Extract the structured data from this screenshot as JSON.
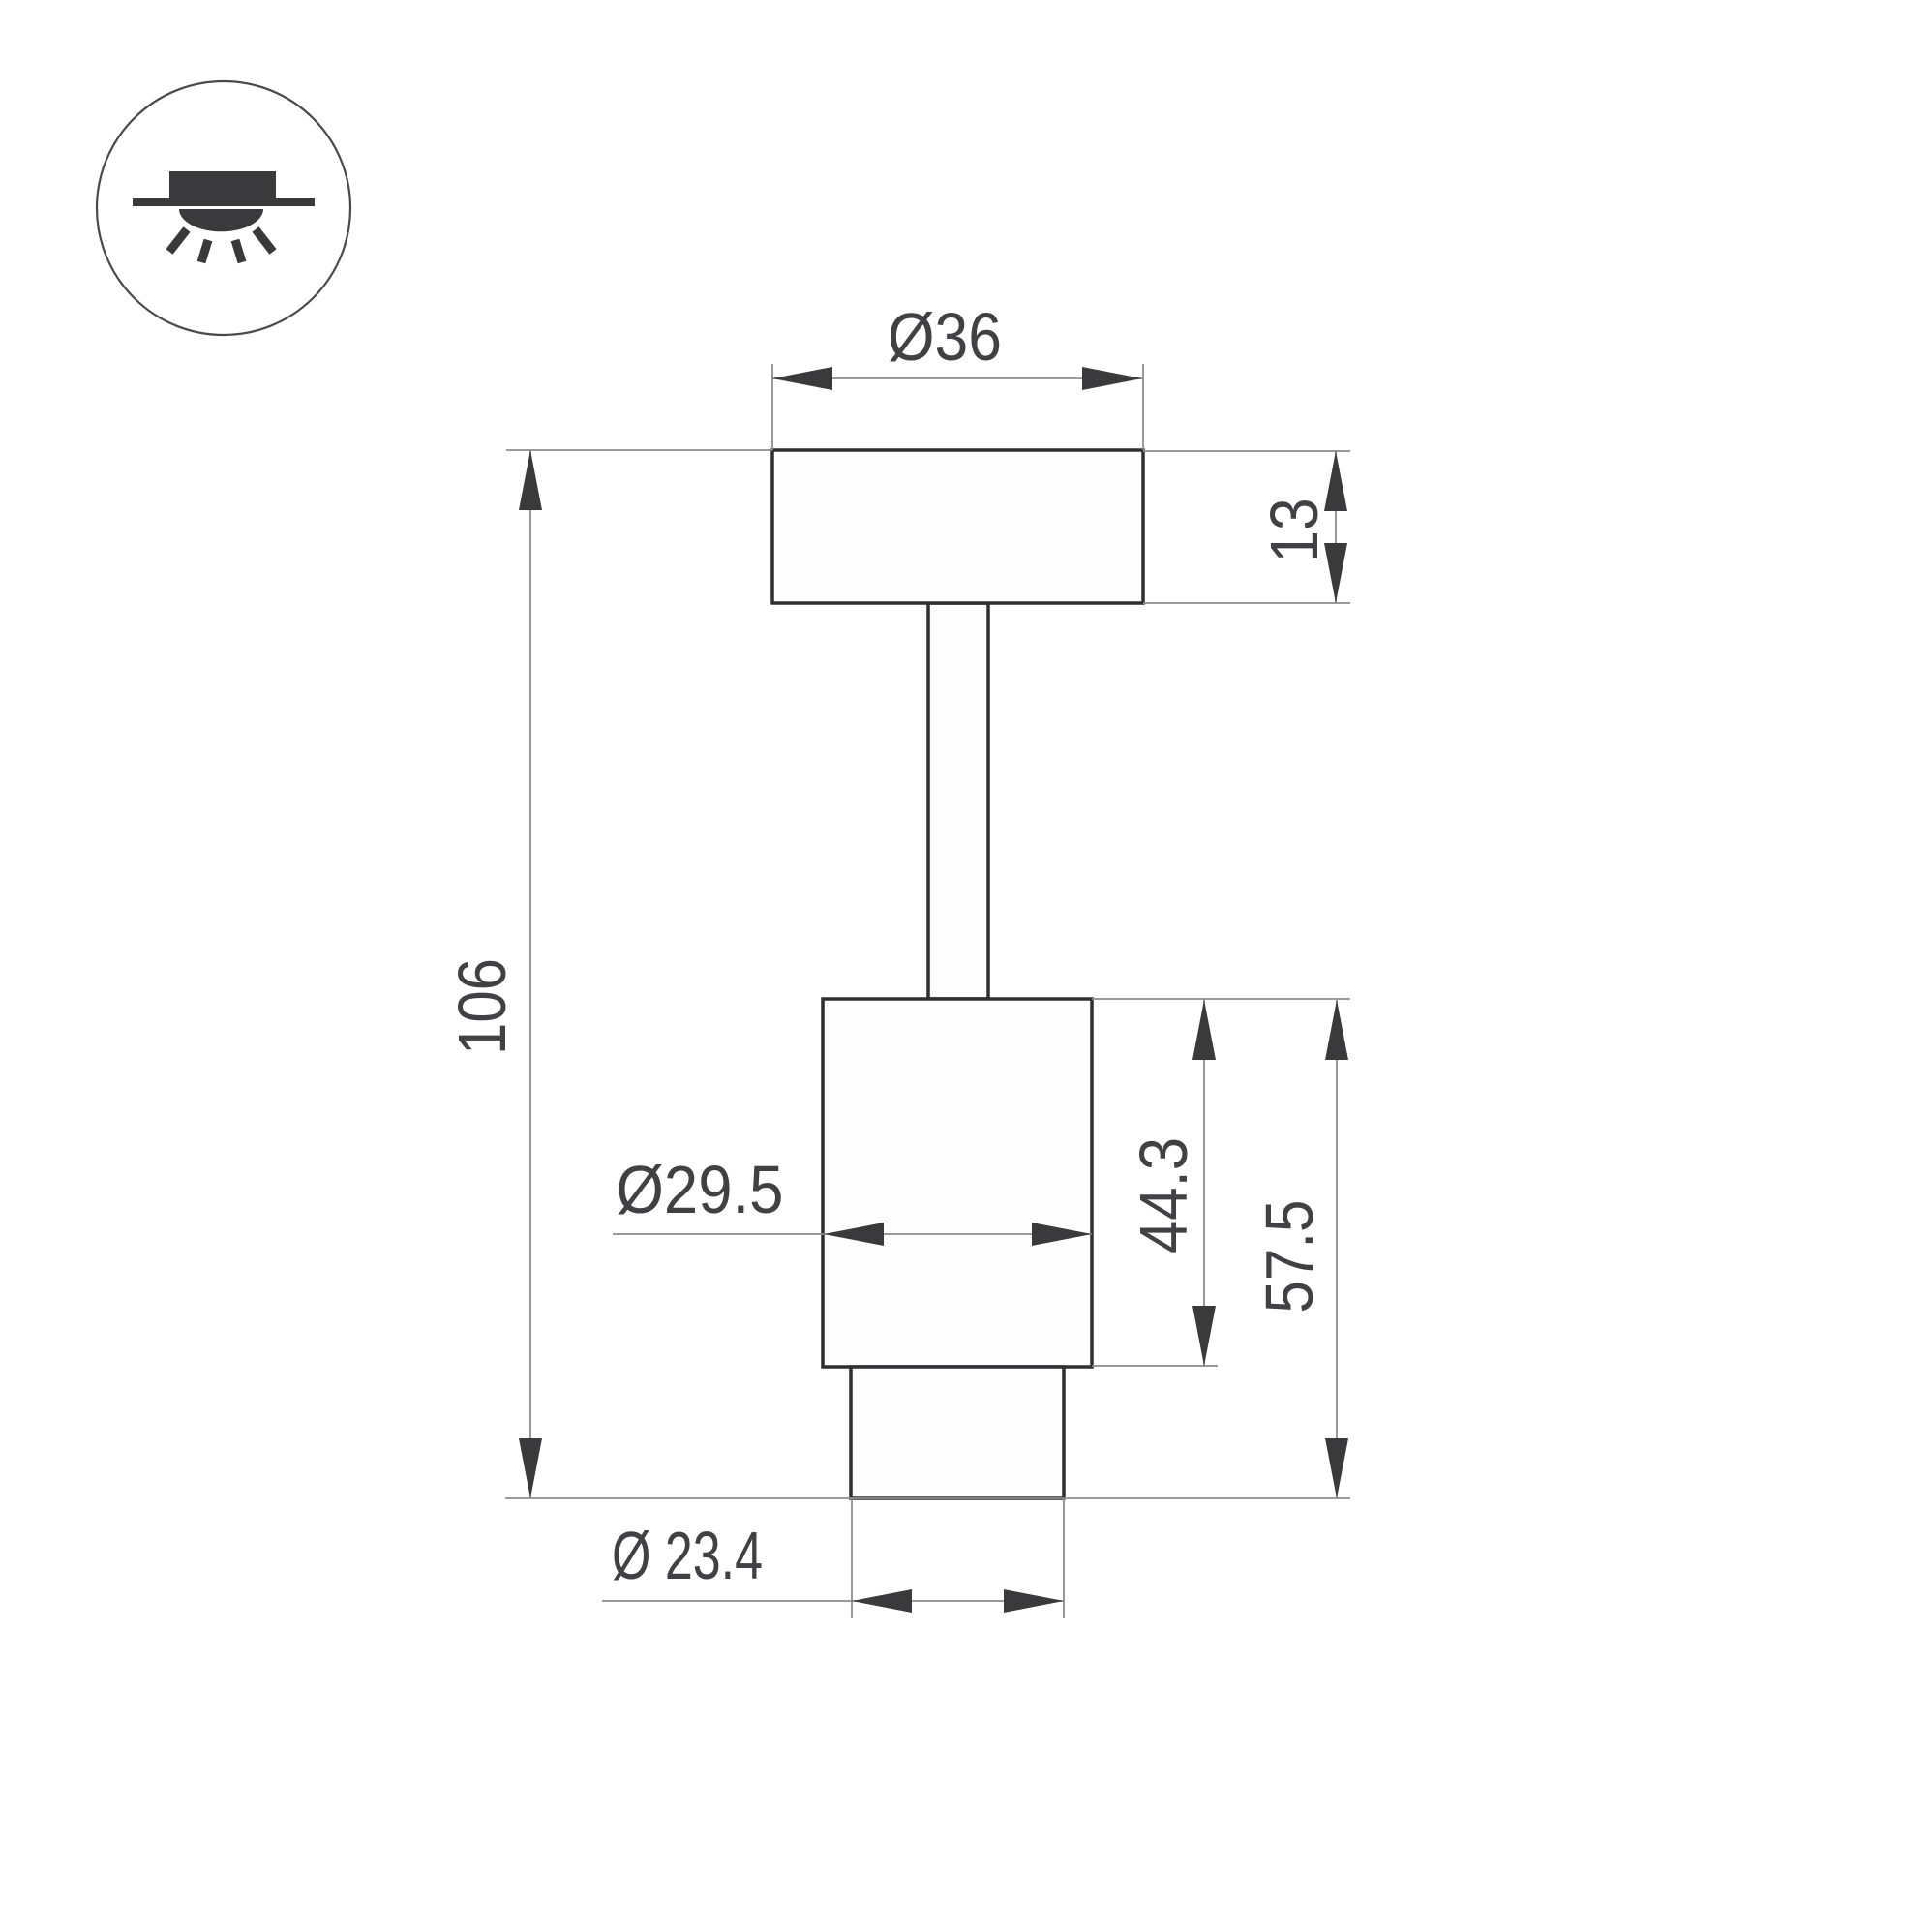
{
  "page": {
    "background": "#ffffff",
    "description_labels_only": true
  },
  "icon": {
    "name": "recessed-ceiling-light-icon",
    "glyph": "ceiling-line-with-housing-dome-and-rays"
  },
  "colors": {
    "outline": "#2f2f31",
    "thin_line": "#8c8c8c",
    "arrow_and_text": "#3f3f42",
    "icon": "#3a3a3c",
    "background": "#ffffff"
  },
  "dimensions": {
    "canopy_diameter": "Ø36",
    "canopy_height": "13",
    "overall_height": "106",
    "body_diameter": "Ø29.5",
    "body_height": "44.3",
    "body_with_nozzle_height": "57.5",
    "nozzle_diameter": "Ø 23.4"
  }
}
